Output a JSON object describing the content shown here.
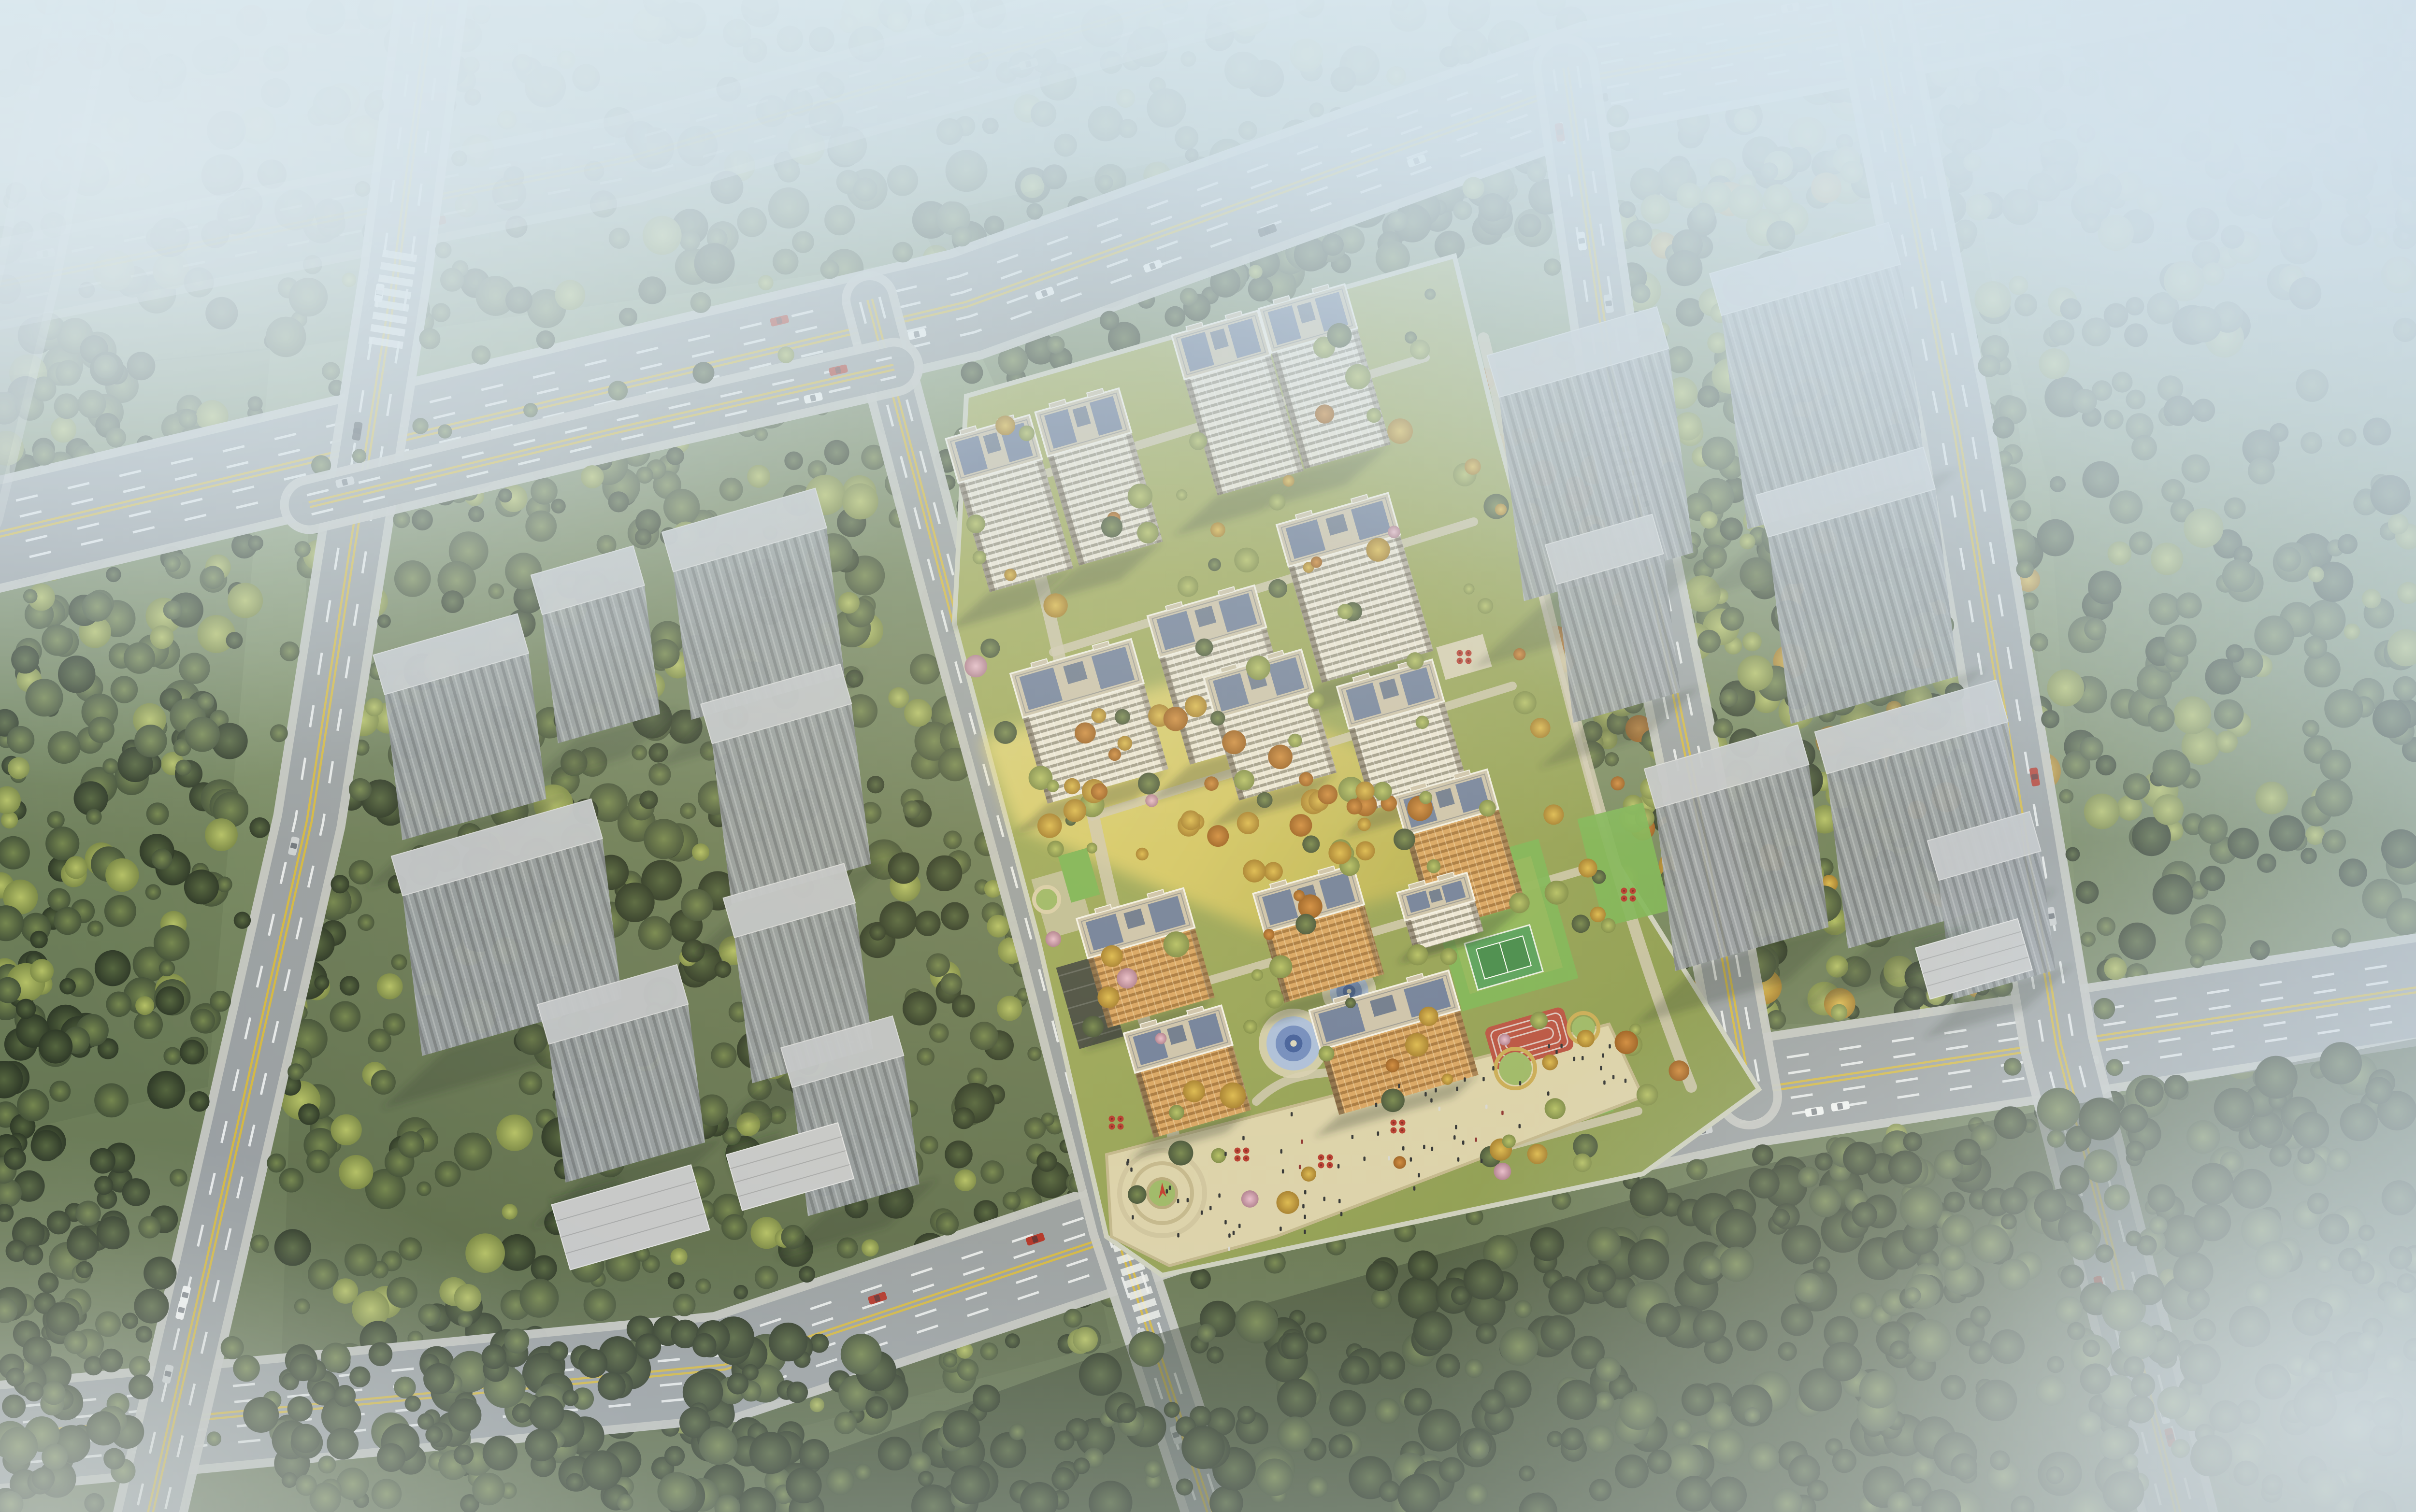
{
  "meta": {
    "title": "Bird's-eye architectural rendering of a residential master plan: white high-rise compound with landscaped amenities surrounded by gray massing blocks, forests and arterial roads fading into haze",
    "type": "3d-architectural-visualization",
    "text_visible": false
  },
  "colors": {
    "fog": "#d8e7ee",
    "fog_deep": "#bcd3de",
    "ground_top": "#9fb29b",
    "ground_mid": "#82956c",
    "ground_low": "#5e6d4c",
    "forest_dark_hi": "#55663f",
    "forest_dark_lo": "#2f3a28",
    "forest_mid_hi": "#75874f",
    "forest_mid_lo": "#46543a",
    "tree_yellow_hi": "#b4c066",
    "tree_yellow_lo": "#7e8c48",
    "tree_gold_hi": "#dcb94f",
    "tree_gold_lo": "#a67f2e",
    "tree_orange_hi": "#d08a3e",
    "tree_orange_lo": "#9c5f22",
    "tree_pink_hi": "#e8bccd",
    "tree_pink_lo": "#b07f92",
    "asphalt": "#9aa0a3",
    "sidewalk": "#c6c8c5",
    "lane_white": "#eef1f2",
    "lane_yellow": "#d7b93e",
    "facade_white": "#ece7da",
    "facade_accent": "#4e4337",
    "roof_deck": "#ccc3ae",
    "roof_panel": "#64779c",
    "roof_edge": "#f3f1e9",
    "facade_orange": "#d8a463",
    "massing_face": "#9aa0a6",
    "massing_top": "#c2c6cb",
    "lawn": "#94a45c",
    "lawn_bright": "#c0bd62",
    "gold_band": "#e3d06b",
    "path": "#cfc8b2",
    "plaza": "#dbd2ac",
    "plaza_edge": "#c2b78e",
    "green_roof": "#7cb457",
    "pool_deep": "#3e5c9e",
    "pool_mid": "#6e8ac2",
    "pool_light": "#aabede",
    "pool_deck": "#d6cfb4",
    "court_green": "#55a05c",
    "court_dark": "#418a4b",
    "track_red": "#b85042",
    "track_line": "#e3e4e2",
    "circle_tan": "#c9ab56",
    "circle_green": "#9cb868",
    "pergola": "#474c42",
    "umbrella_red": "#b5382e",
    "sculpture_red": "#c23a2e",
    "car_white": "#f4f6f6",
    "car_silver": "#cdd1d3",
    "car_dark": "#3c4146",
    "car_red": "#b23227",
    "people": "#2e3134",
    "shadow": "rgba(42,52,40,0.30)"
  },
  "scene": {
    "atmosphere": {
      "fog": "heavy white-blue haze over top edge, top-left, top-right and bottom-right corners",
      "sun": "low warm light casting a golden sunlit band diagonally across the central site"
    },
    "central_development": {
      "white_highrise_towers": 9,
      "orange_midrise_buildings": 5,
      "kindergarten_buildings": 1,
      "amenities": [
        "children-pool-rings",
        "sports-court",
        "running-track",
        "retail-plaza",
        "entry-plaza-circle",
        "roof-gardens",
        "parking-pergola"
      ],
      "landscape": [
        "lawns",
        "golden-autumn-trees",
        "pink-blossom-trees",
        "curved-paths"
      ]
    },
    "context_blocks": {
      "left_gray_massing_buildings": 8,
      "right_gray_massing_buildings": 7,
      "flat_podium_blocks": 3,
      "forest_blocks": 6
    },
    "roads": {
      "arterials": 2,
      "secondary_roads": 6,
      "markings": [
        "double-yellow-center",
        "white-dashed-lanes",
        "zebra-crosswalks"
      ],
      "crosswalks": 4,
      "street_trees": true
    },
    "traffic": {
      "cars": 45,
      "car_colors": [
        "white",
        "silver",
        "dark-gray",
        "red"
      ]
    },
    "people_on_plaza": 75
  }
}
